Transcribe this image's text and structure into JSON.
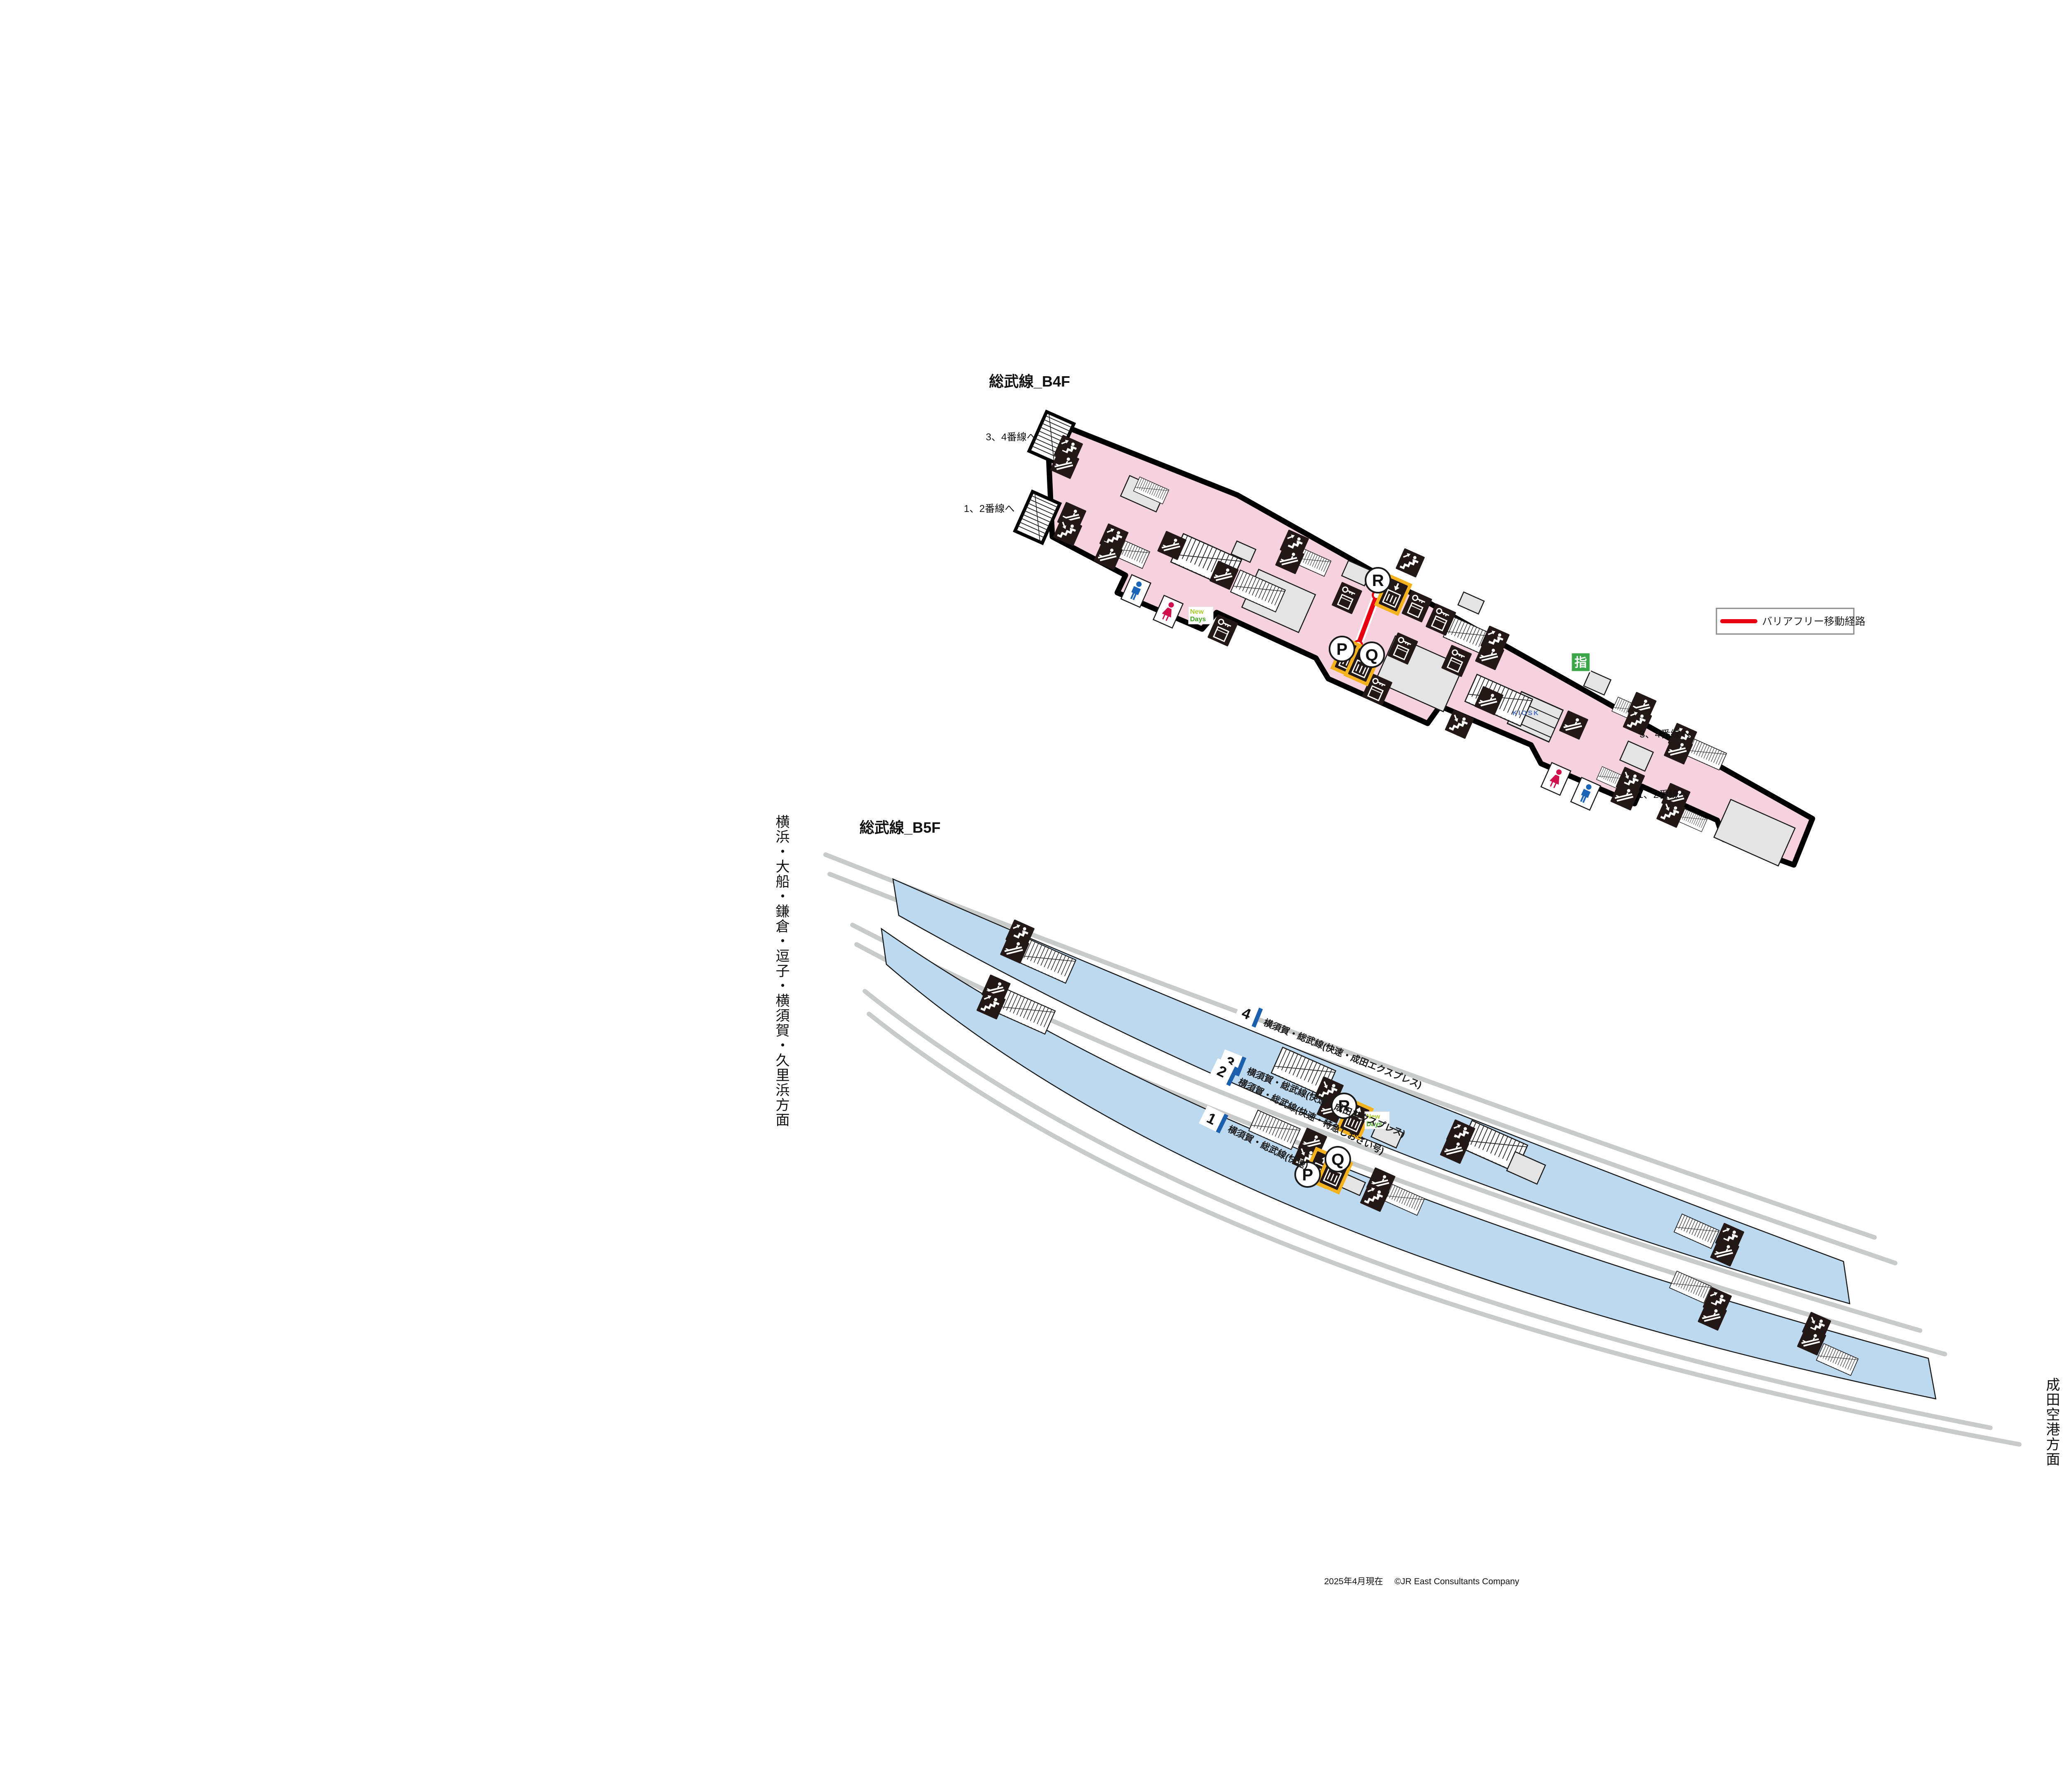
{
  "titles": {
    "b4f": "総武線_B4F",
    "b5f": "総武線_B5F"
  },
  "legend": {
    "barrier_free_route": "バリアフリー移動経路"
  },
  "b4f": {
    "to_tracks_34": "3、4番線へ",
    "to_tracks_12": "1、2番線へ",
    "kiosk": "KIOSK",
    "reserved_seat_machine": "指"
  },
  "b5f": {
    "direction_left": "横浜・大船・鎌倉・逗子・横須賀・久里浜方面",
    "direction_right": "成田空港方面",
    "platforms": [
      {
        "no": "4",
        "line": "横須賀・総武線(快速・成田エクスプレス)"
      },
      {
        "no": "3",
        "line": "横須賀・総武線(快速・成田エクスプレス)"
      },
      {
        "no": "2",
        "line": "横須賀・総武線(快速・特急しおさい号)"
      },
      {
        "no": "1",
        "line": "横須賀・総武線(快速)"
      }
    ]
  },
  "brand": {
    "newdays_top": "New",
    "newdays_bottom": "Days"
  },
  "points": {
    "p": "P",
    "q": "Q",
    "r": "R"
  },
  "footer": {
    "as_of": "2025年4月現在",
    "copyright": "©JR East Consultants Company"
  },
  "colors": {
    "concourse_pink": "#F6D2DF",
    "platform_blue": "#BCD9F0",
    "track_gray": "#C9CACA",
    "icon_black": "#231815",
    "elevator_highlight": "#F5B21F",
    "barrier_free_red": "#E60012",
    "reserved_green": "#3BA64A",
    "wc_male_blue": "#1C64B8",
    "wc_female_red": "#D0104C",
    "platform_number_blue": "#1C5FAD",
    "kiosk_blue": "#4A6FBF",
    "newdays_yellow_green": "#A8CC2E",
    "newdays_green": "#3FA51D"
  }
}
